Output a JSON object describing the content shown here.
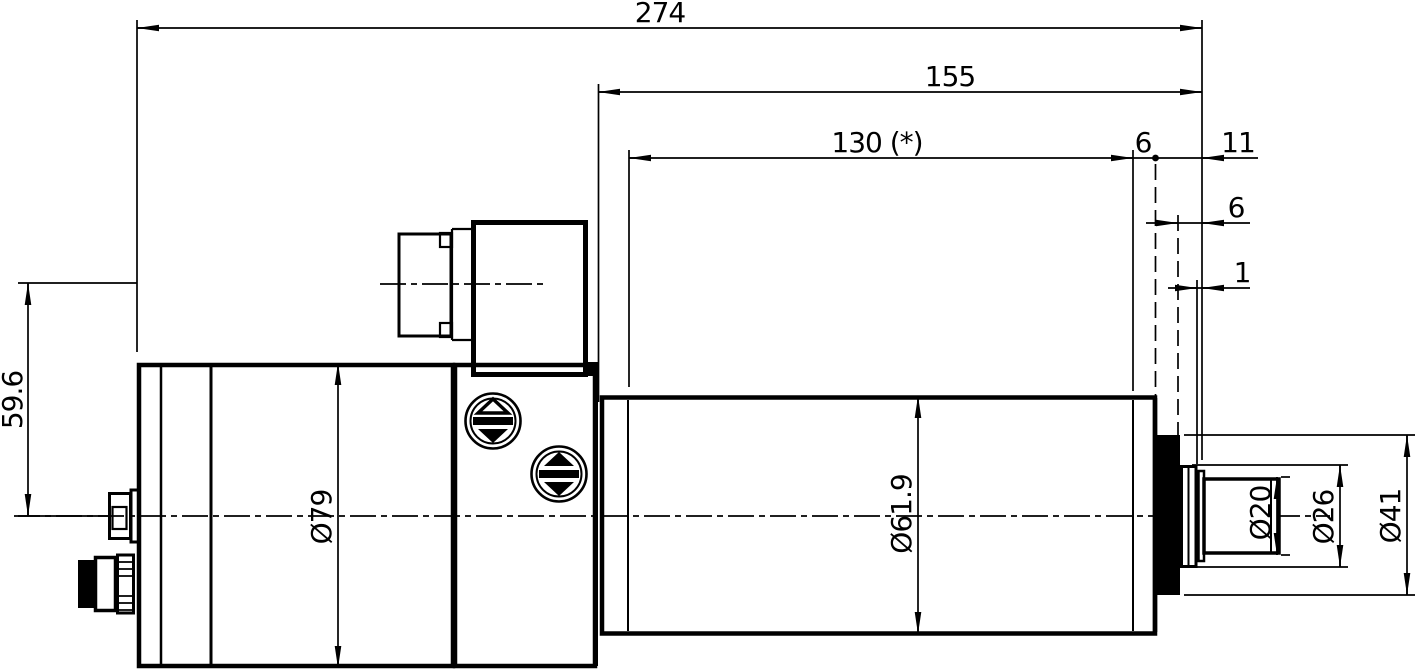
{
  "labels": {
    "len_274": "274",
    "len_155": "155",
    "len_130": "130 (*)",
    "len_6_face": "6",
    "len_11": "11",
    "len_6_collar": "6",
    "len_1": "1",
    "height_59_6": "59.6",
    "dia_79": "Ø79",
    "dia_61_9": "Ø61.9",
    "dia_20": "Ø20",
    "dia_26": "Ø26",
    "dia_41": "Ø41"
  },
  "colors": {
    "line": "#000000",
    "background": "#ffffff"
  }
}
